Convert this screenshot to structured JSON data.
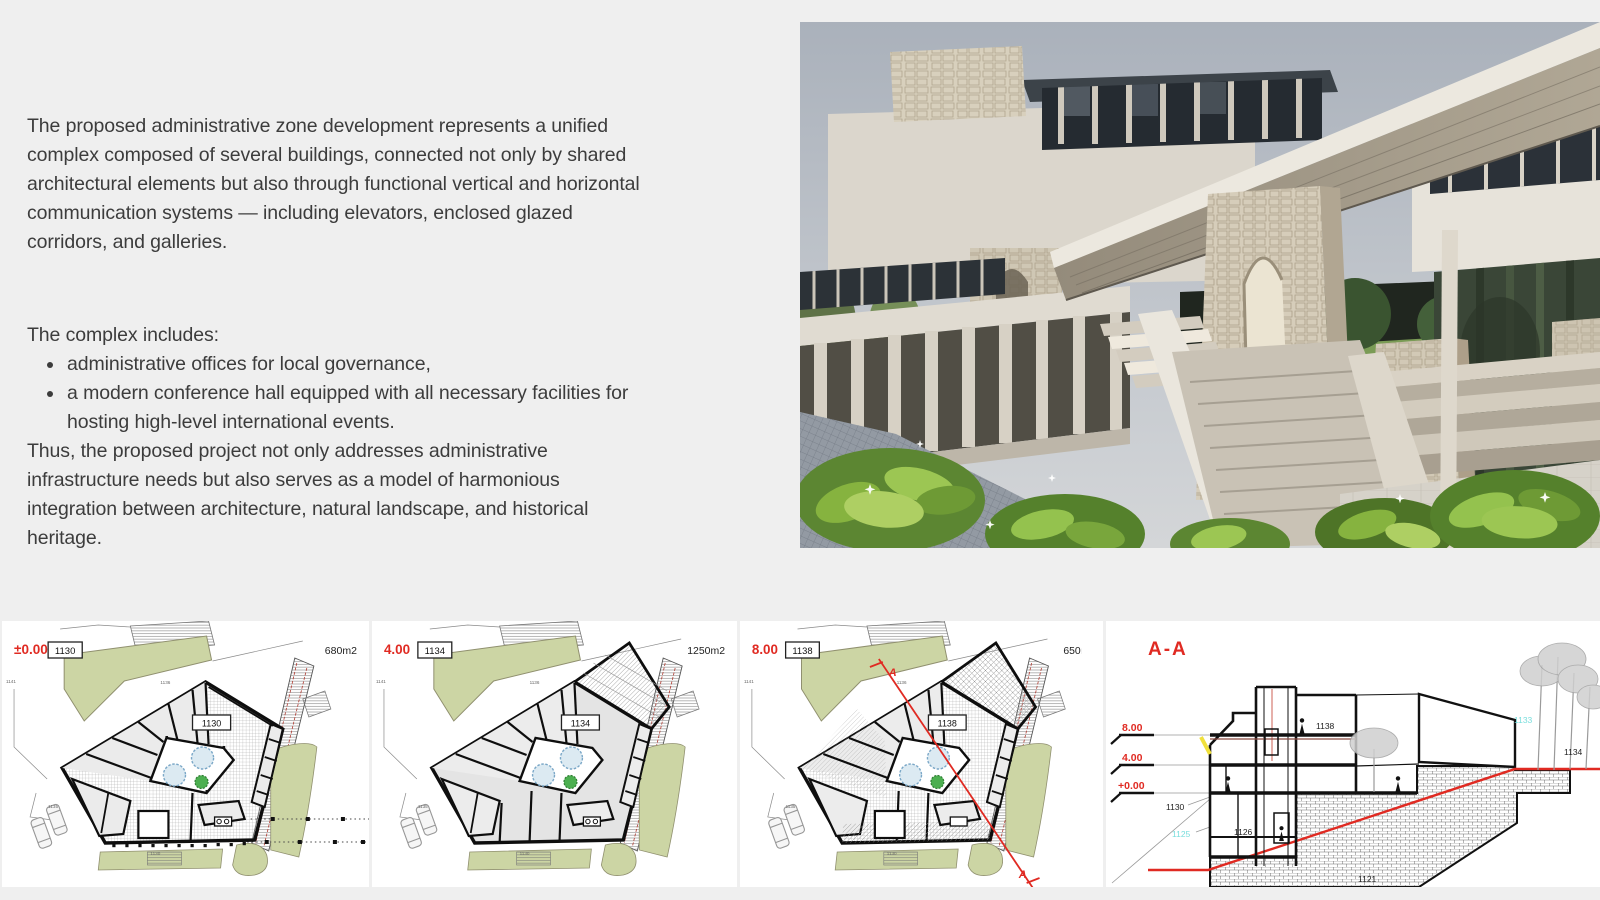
{
  "page": {
    "background": "#efefef"
  },
  "colors": {
    "accent_red": "#e02a22",
    "cyan_label": "#7adedd",
    "lawn_green": "#ccd5a4",
    "text_ink": "#3c3c3c"
  },
  "intro": {
    "paragraph1": "The proposed administrative zone development represents a unified complex composed of several buildings, connected not only by shared architectural elements but also through functional vertical and horizontal communication systems — including elevators, enclosed glazed corridors, and galleries.",
    "includes_heading": "The complex includes:",
    "bullets": [
      "administrative offices for local governance,",
      "a modern conference hall equipped with all necessary facilities for hosting high-level international events."
    ],
    "paragraph2": "Thus, the proposed project not only addresses administrative infrastructure needs but also serves as a model of harmonious integration between architecture, natural landscape, and historical heritage."
  },
  "plans": [
    {
      "level_label": "±0.00",
      "level_tag": "1130",
      "area_label": "680m2",
      "building_tag": "1130",
      "micro_labels": [
        "1141",
        "1136",
        "1135",
        "1130"
      ]
    },
    {
      "level_label": "4.00",
      "level_tag": "1134",
      "area_label": "1250m2",
      "building_tag": "1134",
      "micro_labels": [
        "1141",
        "1136",
        "1135",
        "1130"
      ]
    },
    {
      "level_label": "8.00",
      "level_tag": "1138",
      "area_label": "650m2",
      "building_tag": "1138",
      "section_marker": "A",
      "micro_labels": [
        "1141",
        "1136",
        "1135",
        "1130"
      ]
    }
  ],
  "section": {
    "title": "A-A",
    "level_labels": [
      "8.00",
      "4.00",
      "+0.00"
    ],
    "spot_labels": {
      "s1130": "1130",
      "s1125": "1125",
      "s1126": "1126",
      "s1138": "1138",
      "s1121": "1121",
      "s1133": "1133",
      "s1134": "1134"
    }
  }
}
